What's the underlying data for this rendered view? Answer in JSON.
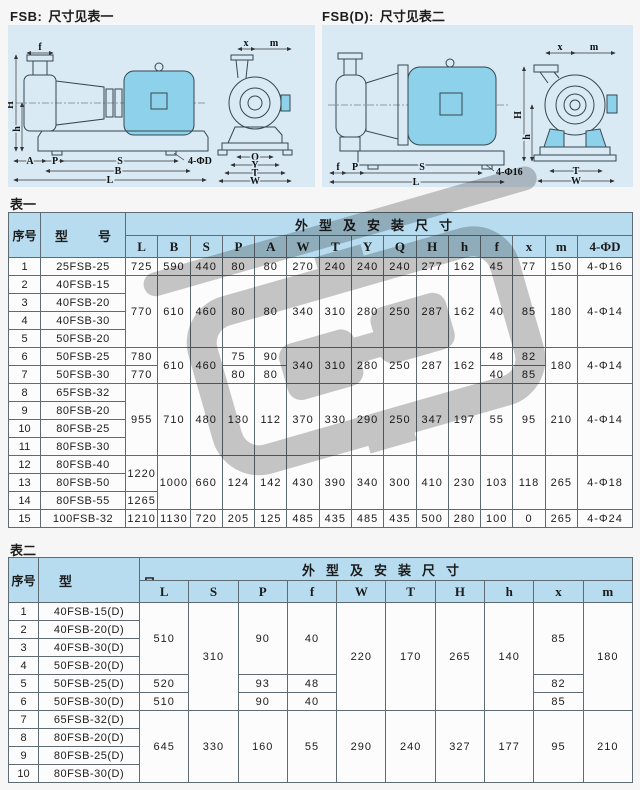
{
  "colors": {
    "header_bg": "#b7dcef",
    "panel_bg": "#d9eaf5",
    "motor_fill": "#8ed1ea",
    "watermark": "#c7c7c7"
  },
  "diagrams": {
    "left": {
      "code": "FSB:",
      "text": "尺寸见表一",
      "labels": {
        "f": "f",
        "H": "H",
        "h": "h",
        "A": "A",
        "P": "P",
        "S": "S",
        "holes": "4-ΦD",
        "B": "B",
        "L": "L",
        "x": "x",
        "m": "m",
        "Q": "Q",
        "Y": "Y",
        "T": "T",
        "W": "W"
      }
    },
    "right": {
      "code": "FSB(D):",
      "text": "尺寸见表二",
      "labels": {
        "f": "f",
        "P": "P",
        "S": "S",
        "L": "L",
        "holes": "4-Φ16",
        "x": "x",
        "m": "m",
        "H": "H",
        "h": "h",
        "T": "T",
        "W": "W"
      }
    }
  },
  "table1": {
    "caption": "表一",
    "index_label": "序号",
    "model_char1": "型",
    "model_char2": "号",
    "group_label": "外型及安装尺寸",
    "col_count": 15,
    "columns": [
      "L",
      "B",
      "S",
      "P",
      "A",
      "W",
      "T",
      "Y",
      "Q",
      "H",
      "h",
      "f",
      "x",
      "m",
      "4-ΦD"
    ],
    "rows": [
      {
        "idx": "1",
        "model": "25FSB-25",
        "cells": [
          {
            "v": "725"
          },
          {
            "v": "590"
          },
          {
            "v": "440"
          },
          {
            "v": "80"
          },
          {
            "v": "80"
          },
          {
            "v": "270"
          },
          {
            "v": "240"
          },
          {
            "v": "240"
          },
          {
            "v": "240"
          },
          {
            "v": "277"
          },
          {
            "v": "162"
          },
          {
            "v": "45"
          },
          {
            "v": "77"
          },
          {
            "v": "150"
          },
          {
            "v": "4-Φ16"
          }
        ]
      },
      {
        "idx": "2",
        "model": "40FSB-15",
        "cells": [
          {
            "v": "770",
            "rs": 4
          },
          {
            "v": "610",
            "rs": 4
          },
          {
            "v": "460",
            "rs": 4
          },
          {
            "v": "80",
            "rs": 4
          },
          {
            "v": "80",
            "rs": 4
          },
          {
            "v": "340",
            "rs": 4
          },
          {
            "v": "310",
            "rs": 4
          },
          {
            "v": "280",
            "rs": 4
          },
          {
            "v": "250",
            "rs": 4
          },
          {
            "v": "287",
            "rs": 4
          },
          {
            "v": "162",
            "rs": 4
          },
          {
            "v": "40",
            "rs": 4
          },
          {
            "v": "85",
            "rs": 4
          },
          {
            "v": "180",
            "rs": 4
          },
          {
            "v": "4-Φ14",
            "rs": 4
          }
        ]
      },
      {
        "idx": "3",
        "model": "40FSB-20",
        "cells": []
      },
      {
        "idx": "4",
        "model": "40FSB-30",
        "cells": []
      },
      {
        "idx": "5",
        "model": "50FSB-20",
        "cells": []
      },
      {
        "idx": "6",
        "model": "50FSB-25",
        "cells": [
          {
            "v": "780"
          },
          {
            "v": "610",
            "rs": 2
          },
          {
            "v": "460",
            "rs": 2
          },
          {
            "v": "75"
          },
          {
            "v": "90"
          },
          {
            "v": "340",
            "rs": 2
          },
          {
            "v": "310",
            "rs": 2
          },
          {
            "v": "280",
            "rs": 2
          },
          {
            "v": "250",
            "rs": 2
          },
          {
            "v": "287",
            "rs": 2
          },
          {
            "v": "162",
            "rs": 2
          },
          {
            "v": "48"
          },
          {
            "v": "82"
          },
          {
            "v": "180",
            "rs": 2
          },
          {
            "v": "4-Φ14",
            "rs": 2
          }
        ]
      },
      {
        "idx": "7",
        "model": "50FSB-30",
        "cells": [
          {
            "v": "770"
          },
          {
            "v": "80"
          },
          {
            "v": "80"
          },
          {
            "v": "40"
          },
          {
            "v": "85"
          }
        ]
      },
      {
        "idx": "8",
        "model": "65FSB-32",
        "cells": [
          {
            "v": "955",
            "rs": 4
          },
          {
            "v": "710",
            "rs": 4
          },
          {
            "v": "480",
            "rs": 4
          },
          {
            "v": "130",
            "rs": 4
          },
          {
            "v": "112",
            "rs": 4
          },
          {
            "v": "370",
            "rs": 4
          },
          {
            "v": "330",
            "rs": 4
          },
          {
            "v": "290",
            "rs": 4
          },
          {
            "v": "250",
            "rs": 4
          },
          {
            "v": "347",
            "rs": 4
          },
          {
            "v": "197",
            "rs": 4
          },
          {
            "v": "55",
            "rs": 4
          },
          {
            "v": "95",
            "rs": 4
          },
          {
            "v": "210",
            "rs": 4
          },
          {
            "v": "4-Φ14",
            "rs": 4
          }
        ]
      },
      {
        "idx": "9",
        "model": "80FSB-20",
        "cells": []
      },
      {
        "idx": "10",
        "model": "80FSB-25",
        "cells": []
      },
      {
        "idx": "11",
        "model": "80FSB-30",
        "cells": []
      },
      {
        "idx": "12",
        "model": "80FSB-40",
        "cells": [
          {
            "v": "1220",
            "rs": 2
          },
          {
            "v": "1000",
            "rs": 3
          },
          {
            "v": "660",
            "rs": 3
          },
          {
            "v": "124",
            "rs": 3
          },
          {
            "v": "142",
            "rs": 3
          },
          {
            "v": "430",
            "rs": 3
          },
          {
            "v": "390",
            "rs": 3
          },
          {
            "v": "340",
            "rs": 3
          },
          {
            "v": "300",
            "rs": 3
          },
          {
            "v": "410",
            "rs": 3
          },
          {
            "v": "230",
            "rs": 3
          },
          {
            "v": "103",
            "rs": 3
          },
          {
            "v": "118",
            "rs": 3
          },
          {
            "v": "265",
            "rs": 3
          },
          {
            "v": "4-Φ18",
            "rs": 3
          }
        ]
      },
      {
        "idx": "13",
        "model": "80FSB-50",
        "cells": []
      },
      {
        "idx": "14",
        "model": "80FSB-55",
        "cells": [
          {
            "v": "1265"
          }
        ]
      },
      {
        "idx": "15",
        "model": "100FSB-32",
        "cells": [
          {
            "v": "1210"
          },
          {
            "v": "1130"
          },
          {
            "v": "720"
          },
          {
            "v": "205"
          },
          {
            "v": "125"
          },
          {
            "v": "485"
          },
          {
            "v": "435"
          },
          {
            "v": "485"
          },
          {
            "v": "435"
          },
          {
            "v": "500"
          },
          {
            "v": "280"
          },
          {
            "v": "100"
          },
          {
            "v": "0"
          },
          {
            "v": "265"
          },
          {
            "v": "4-Φ24"
          }
        ]
      }
    ]
  },
  "table2": {
    "caption": "表二",
    "index_label": "序号",
    "model_char1": "型",
    "model_char2": "号",
    "group_label": "外型及安装尺寸",
    "col_count": 10,
    "columns": [
      "L",
      "S",
      "P",
      "f",
      "W",
      "T",
      "H",
      "h",
      "x",
      "m"
    ],
    "rows": [
      {
        "idx": "1",
        "model": "40FSB-15(D)",
        "cells": [
          {
            "v": "510",
            "rs": 4
          },
          {
            "v": "310",
            "rs": 6
          },
          {
            "v": "90",
            "rs": 4
          },
          {
            "v": "40",
            "rs": 4
          },
          {
            "v": "220",
            "rs": 6
          },
          {
            "v": "170",
            "rs": 6
          },
          {
            "v": "265",
            "rs": 6
          },
          {
            "v": "140",
            "rs": 6
          },
          {
            "v": "85",
            "rs": 4
          },
          {
            "v": "180",
            "rs": 6
          }
        ]
      },
      {
        "idx": "2",
        "model": "40FSB-20(D)",
        "cells": []
      },
      {
        "idx": "3",
        "model": "40FSB-30(D)",
        "cells": []
      },
      {
        "idx": "4",
        "model": "50FSB-20(D)",
        "cells": []
      },
      {
        "idx": "5",
        "model": "50FSB-25(D)",
        "cells": [
          {
            "v": "520"
          },
          {
            "v": "93"
          },
          {
            "v": "48"
          },
          {
            "v": "82"
          }
        ]
      },
      {
        "idx": "6",
        "model": "50FSB-30(D)",
        "cells": [
          {
            "v": "510"
          },
          {
            "v": "90"
          },
          {
            "v": "40"
          },
          {
            "v": "85"
          }
        ]
      },
      {
        "idx": "7",
        "model": "65FSB-32(D)",
        "cells": [
          {
            "v": "645",
            "rs": 4
          },
          {
            "v": "330",
            "rs": 4
          },
          {
            "v": "160",
            "rs": 4
          },
          {
            "v": "55",
            "rs": 4
          },
          {
            "v": "290",
            "rs": 4
          },
          {
            "v": "240",
            "rs": 4
          },
          {
            "v": "327",
            "rs": 4
          },
          {
            "v": "177",
            "rs": 4
          },
          {
            "v": "95",
            "rs": 4
          },
          {
            "v": "210",
            "rs": 4
          }
        ]
      },
      {
        "idx": "8",
        "model": "80FSB-20(D)",
        "cells": []
      },
      {
        "idx": "9",
        "model": "80FSB-25(D)",
        "cells": []
      },
      {
        "idx": "10",
        "model": "80FSB-30(D)",
        "cells": []
      }
    ]
  }
}
